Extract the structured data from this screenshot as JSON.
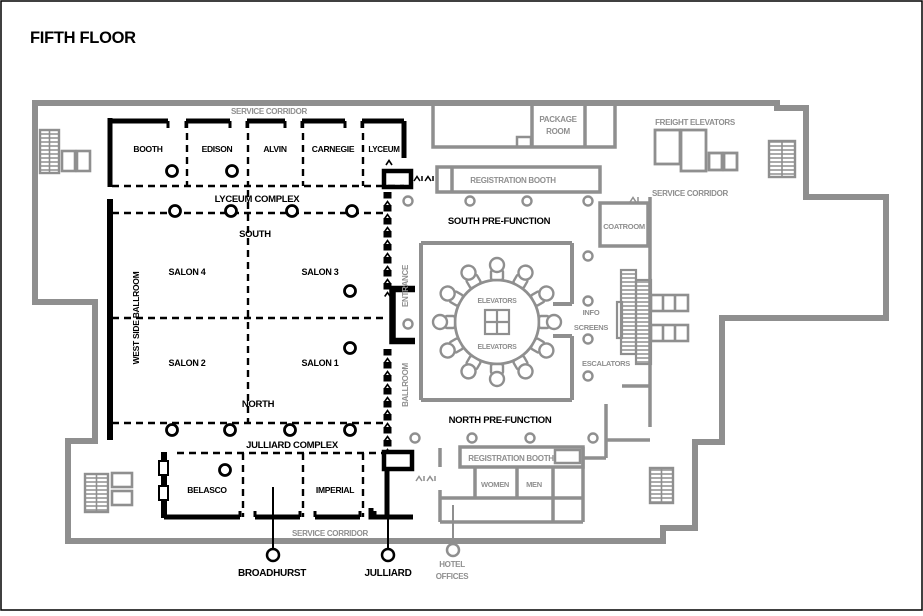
{
  "title": "FIFTH FLOOR",
  "corridors": {
    "top": "SERVICE CORRIDOR",
    "right": "SERVICE CORRIDOR",
    "bottom": "SERVICE CORRIDOR"
  },
  "lyceum": {
    "label": "LYCEUM COMPLEX",
    "rooms": [
      "BOOTH",
      "EDISON",
      "ALVIN",
      "CARNEGIE",
      "LYCEUM"
    ]
  },
  "ballroom": {
    "west": "WEST SIDE BALLROOM",
    "south": "SOUTH",
    "north": "NORTH",
    "salons": [
      "SALON 4",
      "SALON 3",
      "SALON 2",
      "SALON 1"
    ],
    "entrance": "ENTRANCE",
    "name": "BALLROOM"
  },
  "julliard": {
    "label": "JULLIARD COMPLEX",
    "rooms": [
      "BELASCO",
      "IMPERIAL"
    ],
    "callouts": [
      "BROADHURST",
      "JULLIARD"
    ]
  },
  "south_area": {
    "prefunction": "SOUTH PRE-FUNCTION",
    "registration": "REGISTRATION BOOTH",
    "coatroom": "COATROOM",
    "package1": "PACKAGE",
    "package2": "ROOM"
  },
  "north_area": {
    "prefunction": "NORTH PRE-FUNCTION",
    "registration": "REGISTRATION BOOTH",
    "women": "WOMEN",
    "men": "MEN",
    "hotel1": "HOTEL",
    "hotel2": "OFFICES"
  },
  "core": {
    "elevators_top": "ELEVATORS",
    "elevators_bottom": "ELEVATORS",
    "info1": "INFO",
    "info2": "SCREENS",
    "escalators": "ESCALATORS",
    "freight": "FREIGHT ELEVATORS"
  },
  "colors": {
    "wall": "#8f8f8f",
    "ink": "#000000"
  }
}
